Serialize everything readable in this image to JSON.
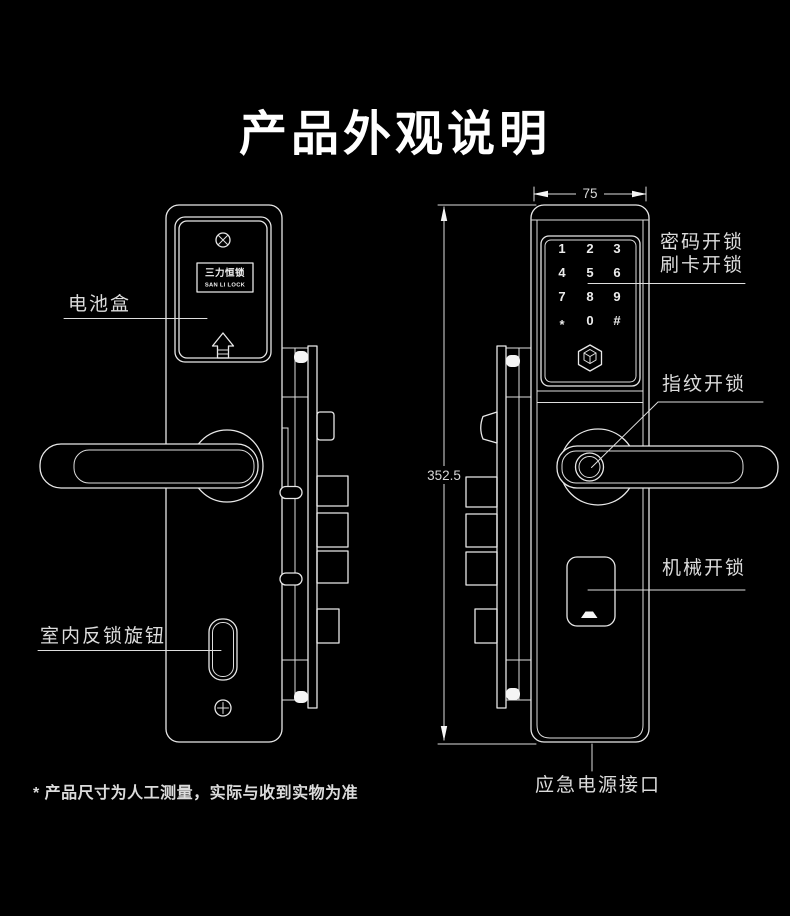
{
  "title": "产品外观说明",
  "footnote": "* 产品尺寸为人工测量，实际与收到实物为准",
  "brand_plate": {
    "line1": "三力恒锁",
    "line2": "SAN LI LOCK"
  },
  "labels": {
    "battery_box": "电池盒",
    "indoor_deadbolt_knob": "室内反锁旋钮",
    "password_unlock": "密码开锁",
    "card_unlock": "刷卡开锁",
    "fingerprint_unlock": "指纹开锁",
    "mechanical_unlock": "机械开锁",
    "emergency_power_port": "应急电源接口"
  },
  "dimensions": {
    "width_mm": "75",
    "height_mm": "352.5"
  },
  "keypad_keys": [
    "1",
    "2",
    "3",
    "4",
    "5",
    "6",
    "7",
    "8",
    "9",
    "*",
    "0",
    "#"
  ],
  "colors": {
    "background": "#000000",
    "line": "#e8e8e8",
    "text": "#dcdcdc",
    "title": "#ffffff"
  }
}
